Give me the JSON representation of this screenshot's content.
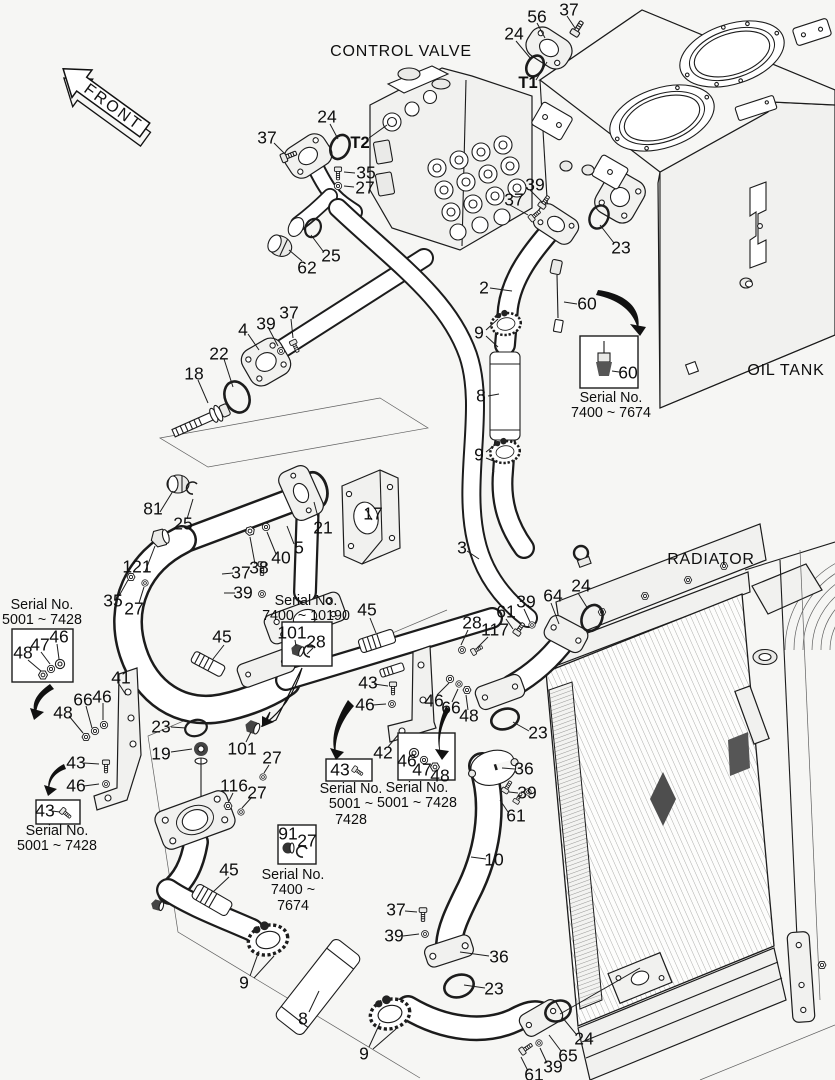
{
  "page": {
    "background": "#f6f6f4",
    "ink": "#1c1c1c",
    "diamond_color": "#4e4e4e"
  },
  "titles": {
    "front_arrow": "FRONT",
    "control_valve": "CONTROL VALVE",
    "oil_tank": "OIL TANK",
    "radiator": "RADIATOR"
  },
  "labels": [
    {
      "text": "56",
      "x": 537,
      "y": 17
    },
    {
      "text": "37",
      "x": 569,
      "y": 10
    },
    {
      "text": "24",
      "x": 514,
      "y": 34
    },
    {
      "text": "T1",
      "x": 528,
      "y": 83,
      "bold": true
    },
    {
      "text": "24",
      "x": 327,
      "y": 117
    },
    {
      "text": "T2",
      "x": 360,
      "y": 143,
      "bold": true
    },
    {
      "text": "37",
      "x": 267,
      "y": 138
    },
    {
      "text": "35",
      "x": 366,
      "y": 173
    },
    {
      "text": "27",
      "x": 365,
      "y": 188
    },
    {
      "text": "25",
      "x": 331,
      "y": 256
    },
    {
      "text": "62",
      "x": 307,
      "y": 268
    },
    {
      "text": "39",
      "x": 535,
      "y": 185
    },
    {
      "text": "37",
      "x": 514,
      "y": 200
    },
    {
      "text": "23",
      "x": 621,
      "y": 248
    },
    {
      "text": "2",
      "x": 484,
      "y": 288
    },
    {
      "text": "60",
      "x": 587,
      "y": 304
    },
    {
      "text": "9",
      "x": 479,
      "y": 333
    },
    {
      "text": "8",
      "x": 481,
      "y": 396
    },
    {
      "text": "9",
      "x": 479,
      "y": 455
    },
    {
      "text": "60",
      "x": 628,
      "y": 373
    },
    {
      "text": "4",
      "x": 243,
      "y": 330
    },
    {
      "text": "39",
      "x": 266,
      "y": 324
    },
    {
      "text": "37",
      "x": 289,
      "y": 313
    },
    {
      "text": "22",
      "x": 219,
      "y": 354
    },
    {
      "text": "18",
      "x": 194,
      "y": 374
    },
    {
      "text": "81",
      "x": 153,
      "y": 509
    },
    {
      "text": "25",
      "x": 183,
      "y": 524
    },
    {
      "text": "17",
      "x": 373,
      "y": 514
    },
    {
      "text": "21",
      "x": 323,
      "y": 528
    },
    {
      "text": "121",
      "x": 137,
      "y": 567
    },
    {
      "text": "35",
      "x": 113,
      "y": 601
    },
    {
      "text": "27",
      "x": 134,
      "y": 609
    },
    {
      "text": "5",
      "x": 299,
      "y": 548
    },
    {
      "text": "40",
      "x": 281,
      "y": 558
    },
    {
      "text": "38",
      "x": 259,
      "y": 568
    },
    {
      "text": "37",
      "x": 241,
      "y": 573
    },
    {
      "text": "39",
      "x": 243,
      "y": 593
    },
    {
      "text": "3",
      "x": 462,
      "y": 548
    },
    {
      "text": "45",
      "x": 222,
      "y": 637
    },
    {
      "text": "45",
      "x": 367,
      "y": 610
    },
    {
      "text": "101",
      "x": 292,
      "y": 633
    },
    {
      "text": "28",
      "x": 316,
      "y": 642
    },
    {
      "text": "28",
      "x": 472,
      "y": 623
    },
    {
      "text": "117",
      "x": 495,
      "y": 630
    },
    {
      "text": "61",
      "x": 506,
      "y": 612
    },
    {
      "text": "39",
      "x": 526,
      "y": 602
    },
    {
      "text": "64",
      "x": 553,
      "y": 596
    },
    {
      "text": "24",
      "x": 581,
      "y": 586
    },
    {
      "text": "46",
      "x": 59,
      "y": 637
    },
    {
      "text": "47",
      "x": 40,
      "y": 645
    },
    {
      "text": "48",
      "x": 23,
      "y": 653
    },
    {
      "text": "41",
      "x": 121,
      "y": 678
    },
    {
      "text": "66",
      "x": 83,
      "y": 700
    },
    {
      "text": "46",
      "x": 102,
      "y": 697
    },
    {
      "text": "48",
      "x": 63,
      "y": 713
    },
    {
      "text": "23",
      "x": 161,
      "y": 727
    },
    {
      "text": "19",
      "x": 161,
      "y": 754
    },
    {
      "text": "43",
      "x": 76,
      "y": 763
    },
    {
      "text": "46",
      "x": 76,
      "y": 786
    },
    {
      "text": "43",
      "x": 45,
      "y": 811
    },
    {
      "text": "101",
      "x": 242,
      "y": 749
    },
    {
      "text": "27",
      "x": 272,
      "y": 758
    },
    {
      "text": "116",
      "x": 234,
      "y": 786
    },
    {
      "text": "27",
      "x": 257,
      "y": 793
    },
    {
      "text": "43",
      "x": 368,
      "y": 683
    },
    {
      "text": "46",
      "x": 365,
      "y": 705
    },
    {
      "text": "42",
      "x": 383,
      "y": 753
    },
    {
      "text": "46",
      "x": 434,
      "y": 701
    },
    {
      "text": "66",
      "x": 451,
      "y": 708
    },
    {
      "text": "48",
      "x": 469,
      "y": 716
    },
    {
      "text": "46",
      "x": 407,
      "y": 761
    },
    {
      "text": "47",
      "x": 422,
      "y": 770
    },
    {
      "text": "48",
      "x": 440,
      "y": 776
    },
    {
      "text": "43",
      "x": 340,
      "y": 770
    },
    {
      "text": "91",
      "x": 288,
      "y": 834
    },
    {
      "text": "27",
      "x": 307,
      "y": 841
    },
    {
      "text": "23",
      "x": 538,
      "y": 733
    },
    {
      "text": "36",
      "x": 524,
      "y": 769
    },
    {
      "text": "39",
      "x": 527,
      "y": 793
    },
    {
      "text": "61",
      "x": 516,
      "y": 816
    },
    {
      "text": "10",
      "x": 494,
      "y": 860
    },
    {
      "text": "45",
      "x": 229,
      "y": 870
    },
    {
      "text": "37",
      "x": 396,
      "y": 910
    },
    {
      "text": "39",
      "x": 394,
      "y": 936
    },
    {
      "text": "9",
      "x": 244,
      "y": 983
    },
    {
      "text": "8",
      "x": 303,
      "y": 1019
    },
    {
      "text": "9",
      "x": 364,
      "y": 1054
    },
    {
      "text": "36",
      "x": 499,
      "y": 957
    },
    {
      "text": "23",
      "x": 494,
      "y": 989
    },
    {
      "text": "24",
      "x": 584,
      "y": 1039
    },
    {
      "text": "65",
      "x": 568,
      "y": 1056
    },
    {
      "text": "39",
      "x": 553,
      "y": 1067
    },
    {
      "text": "61",
      "x": 534,
      "y": 1075
    }
  ],
  "serial_notes": [
    {
      "lines": [
        "Serial No.",
        "7400 ~ 7674"
      ],
      "x": 611,
      "y": 391
    },
    {
      "lines": [
        "Serial No.",
        "5001 ~ 7428"
      ],
      "x": 42,
      "y": 598
    },
    {
      "lines": [
        "Serial No.",
        "5001 ~ 7428"
      ],
      "x": 57,
      "y": 824
    },
    {
      "lines": [
        "Serial No.",
        "7400 ~ 10190"
      ],
      "x": 306,
      "y": 594
    },
    {
      "lines": [
        "Serial No.",
        "5001 ~",
        "7428"
      ],
      "x": 351,
      "y": 782
    },
    {
      "lines": [
        "Serial No.",
        "5001 ~ 7428"
      ],
      "x": 417,
      "y": 781
    },
    {
      "lines": [
        "Serial No.",
        "7400 ~",
        "7674"
      ],
      "x": 293,
      "y": 868
    }
  ]
}
